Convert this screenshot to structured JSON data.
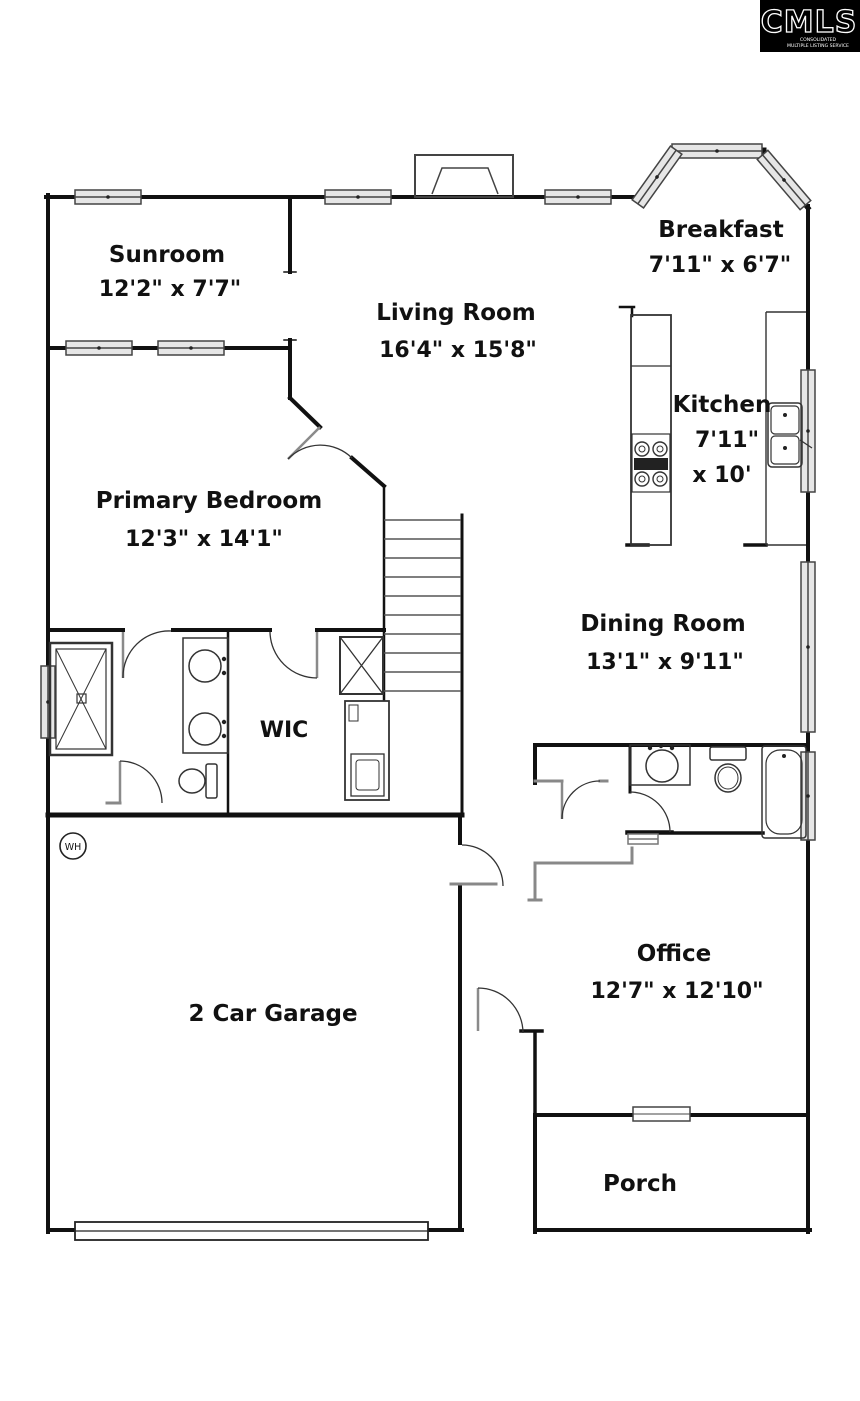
{
  "logo": {
    "brand": "CMLS",
    "caption_line1": "CONSOLIDATED",
    "caption_line2": "MULTIPLE LISTING SERVICE"
  },
  "rooms": {
    "sunroom": {
      "name": "Sunroom",
      "dims": "12'2\" x 7'7\""
    },
    "living": {
      "name": "Living Room",
      "dims": "16'4\" x 15'8\""
    },
    "breakfast": {
      "name": "Breakfast",
      "dims": "7'11\" x 6'7\""
    },
    "kitchen": {
      "name": "Kitchen",
      "dims_line1": "7'11\"",
      "dims_line2": "x 10'"
    },
    "primary": {
      "name": "Primary Bedroom",
      "dims": "12'3\" x 14'1\""
    },
    "dining": {
      "name": "Dining Room",
      "dims": "13'1\" x 9'11\""
    },
    "wic": {
      "name": "WIC"
    },
    "office": {
      "name": "Office",
      "dims": "12'7\" x 12'10\""
    },
    "garage": {
      "name": "2 Car Garage"
    },
    "porch": {
      "name": "Porch"
    }
  },
  "fixtures": {
    "water_heater": "WH"
  },
  "colors": {
    "wall": "#111111",
    "thin_wall": "#888888",
    "fixture": "#333333",
    "window_fill": "#e6e6e6",
    "background": "#ffffff",
    "logo_bg": "#000000",
    "logo_text": "#ffffff"
  }
}
